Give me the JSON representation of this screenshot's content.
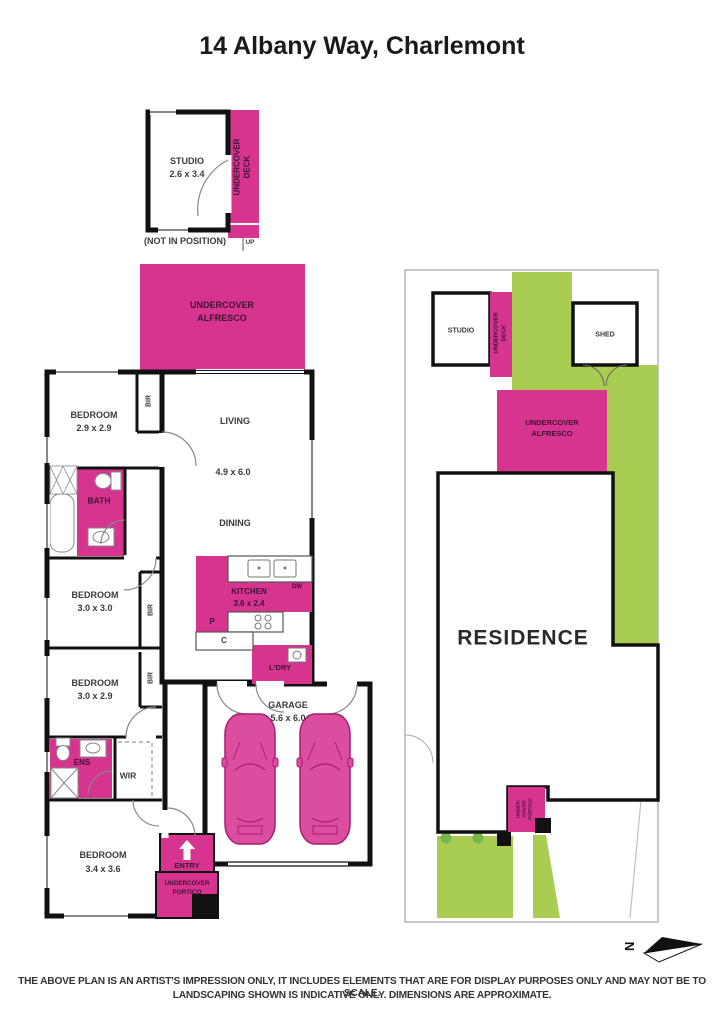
{
  "title": "14 Albany Way, Charlemont",
  "colors": {
    "pink": "#d6348f",
    "green": "#a9cc52",
    "tree_green": "#76b84c",
    "wall_black": "#111111",
    "car_pink": "#da4d9f"
  },
  "studio_unit": {
    "name": "STUDIO",
    "dims": "2.6 x 3.4",
    "deck_line1": "UNDERCOVER",
    "deck_line2": "DECK",
    "note": "(NOT IN POSITION)",
    "up": "UP"
  },
  "alfresco": {
    "line1": "UNDERCOVER",
    "line2": "ALFRESCO"
  },
  "floorplan": {
    "bedroom1": {
      "name": "BEDROOM",
      "dims": "2.9 x 2.9"
    },
    "bir1": "BIR",
    "living": "LIVING",
    "living_dims": "4.9 x 6.0",
    "dining": "DINING",
    "bath": "BATH",
    "bedroom2": {
      "name": "BEDROOM",
      "dims": "3.0 x 3.0"
    },
    "bir2": "BIR",
    "bedroom3": {
      "name": "BEDROOM",
      "dims": "3.0 x 2.9"
    },
    "bir3": "BIR",
    "kitchen": {
      "name": "KITCHEN",
      "dims": "3.6 x 2.4",
      "dw": "DW",
      "pantry": "P",
      "cupboard": "C",
      "laundry": "L'DRY"
    },
    "ens": "ENS",
    "wir": "WIR",
    "bedroom4": {
      "name": "BEDROOM",
      "dims": "3.4 x 3.6"
    },
    "entry": "ENTRY",
    "portico_line1": "UNDERCOVER",
    "portico_line2": "PORTICO",
    "garage": {
      "name": "GARAGE",
      "dims": "5.6 x 6.0"
    }
  },
  "siteplan": {
    "studio": "STUDIO",
    "deck_line1": "UNDERCOVER",
    "deck_line2": "DECK",
    "shed": "SHED",
    "alfresco_line1": "UNDERCOVER",
    "alfresco_line2": "ALFRESCO",
    "residence": "RESIDENCE",
    "portico_line1": "UNDER-",
    "portico_line2": "COVER",
    "portico_line3": "PORTICO"
  },
  "compass": {
    "north": "N"
  },
  "disclaimer": {
    "line1": "THE ABOVE PLAN IS AN ARTIST'S IMPRESSION ONLY, IT INCLUDES ELEMENTS THAT ARE FOR DISPLAY PURPOSES ONLY AND MAY NOT BE TO SCALE.",
    "line2": "LANDSCAPING SHOWN IS INDICATIVE ONLY. DIMENSIONS ARE APPROXIMATE."
  }
}
